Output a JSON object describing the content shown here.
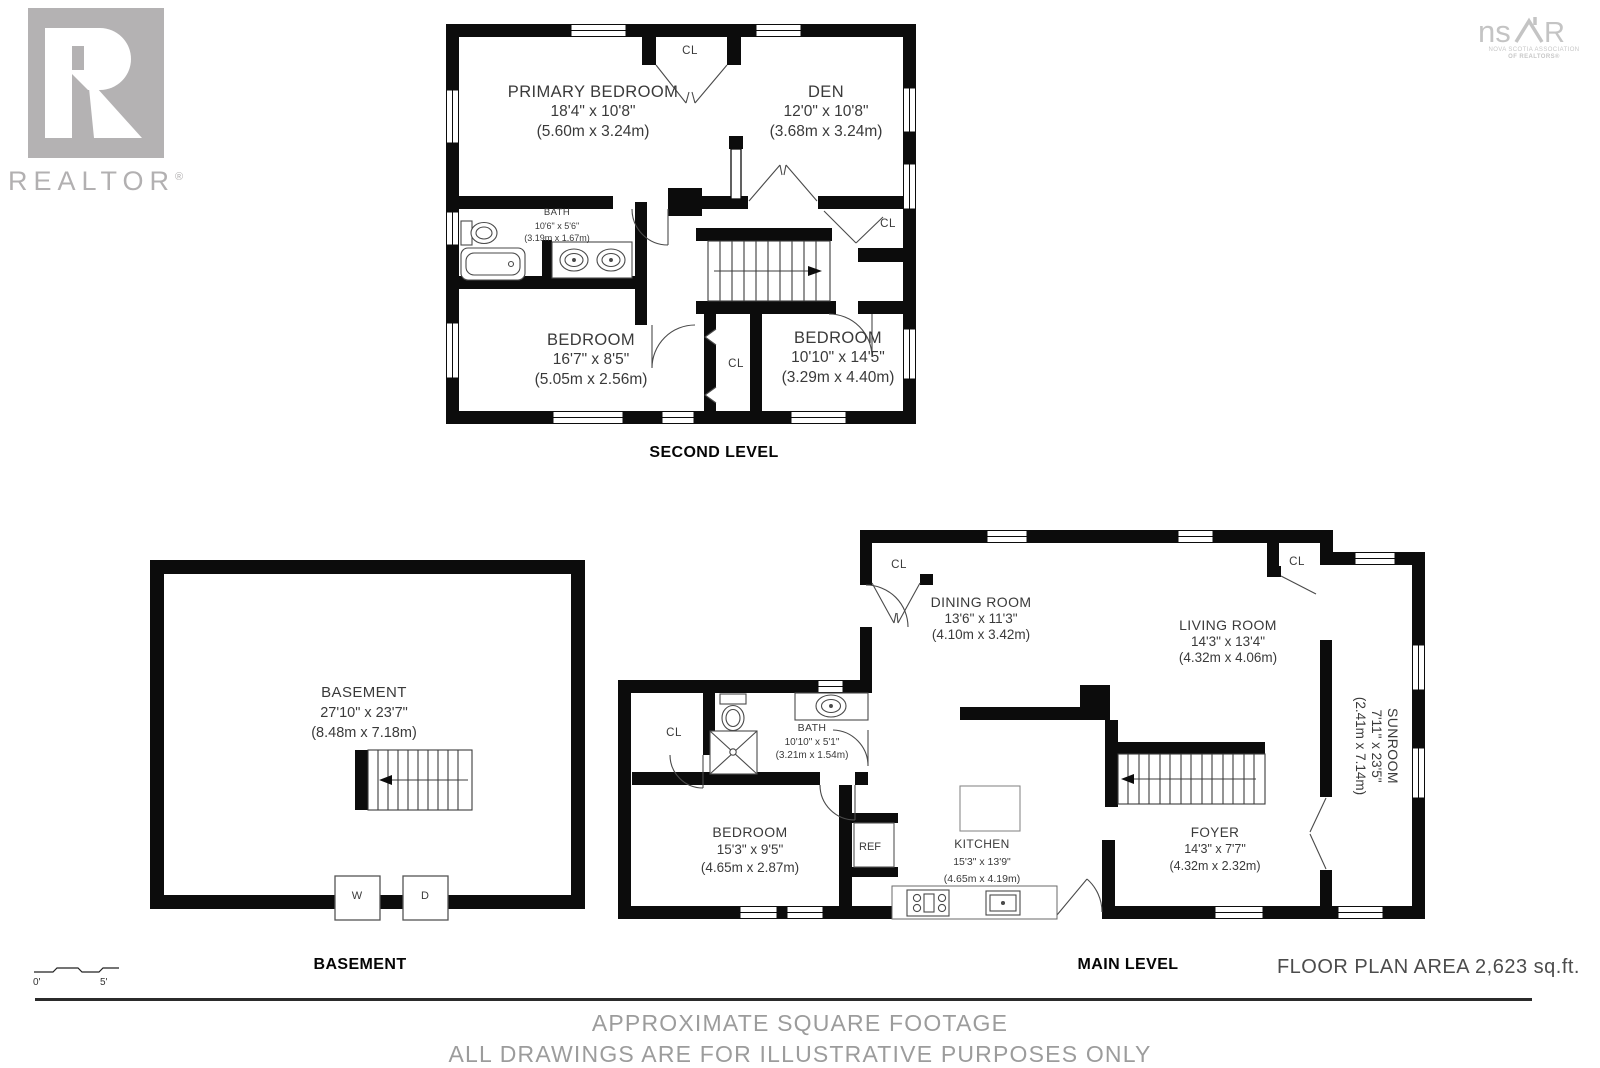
{
  "branding": {
    "realtor": {
      "label": "REALTOR",
      "reg": "®"
    },
    "nsar": {
      "prefix": "ns",
      "suffix": "R",
      "sub1": "NOVA SCOTIA ASSOCIATION",
      "sub2": "OF REALTORS®"
    }
  },
  "plans": {
    "second_level": {
      "title": "SECOND LEVEL",
      "rooms": {
        "primary_bedroom": {
          "name": "PRIMARY BEDROOM",
          "imperial": "18'4\" x 10'8\"",
          "metric": "(5.60m x 3.24m)"
        },
        "den": {
          "name": "DEN",
          "imperial": "12'0\" x 10'8\"",
          "metric": "(3.68m x 3.24m)"
        },
        "bath": {
          "name": "BATH",
          "imperial": "10'6\" x 5'6\"",
          "metric": "(3.19m x 1.67m)"
        },
        "bedroom_left": {
          "name": "BEDROOM",
          "imperial": "16'7\" x 8'5\"",
          "metric": "(5.05m x 2.56m)"
        },
        "bedroom_right": {
          "name": "BEDROOM",
          "imperial": "10'10\" x 14'5\"",
          "metric": "(3.29m x 4.40m)"
        },
        "closet_top": "CL",
        "closet_right": "CL",
        "closet_hall": "CL"
      }
    },
    "main_level": {
      "title": "MAIN LEVEL",
      "rooms": {
        "dining_room": {
          "name": "DINING ROOM",
          "imperial": "13'6\" x 11'3\"",
          "metric": "(4.10m x 3.42m)"
        },
        "living_room": {
          "name": "LIVING ROOM",
          "imperial": "14'3\" x 13'4\"",
          "metric": "(4.32m x 4.06m)"
        },
        "sunroom": {
          "name": "SUNROOM",
          "imperial": "7'11\" x 23'5\"",
          "metric": "(2.41m x 7.14m)"
        },
        "bath": {
          "name": "BATH",
          "imperial": "10'10\" x 5'1\"",
          "metric": "(3.21m x 1.54m)"
        },
        "bedroom": {
          "name": "BEDROOM",
          "imperial": "15'3\" x 9'5\"",
          "metric": "(4.65m x 2.87m)"
        },
        "kitchen": {
          "name": "KITCHEN",
          "imperial": "15'3\" x 13'9\"",
          "metric": "(4.65m x 4.19m)"
        },
        "foyer": {
          "name": "FOYER",
          "imperial": "14'3\" x 7'7\"",
          "metric": "(4.32m x 2.32m)"
        },
        "fridge": "REF",
        "closet_dining": "CL",
        "closet_living": "CL",
        "closet_bedroom": "CL"
      }
    },
    "basement": {
      "title": "BASEMENT",
      "rooms": {
        "basement": {
          "name": "BASEMENT",
          "imperial": "27'10\" x 23'7\"",
          "metric": "(8.48m x 7.18m)"
        },
        "washer": "W",
        "dryer": "D"
      }
    }
  },
  "scale_bar": {
    "start": "0'",
    "end": "5'"
  },
  "footer": {
    "floor_area": "FLOOR PLAN AREA 2,623 sq.ft.",
    "line1": "APPROXIMATE SQUARE FOOTAGE",
    "line2": "ALL DRAWINGS ARE FOR ILLUSTRATIVE PURPOSES ONLY"
  }
}
